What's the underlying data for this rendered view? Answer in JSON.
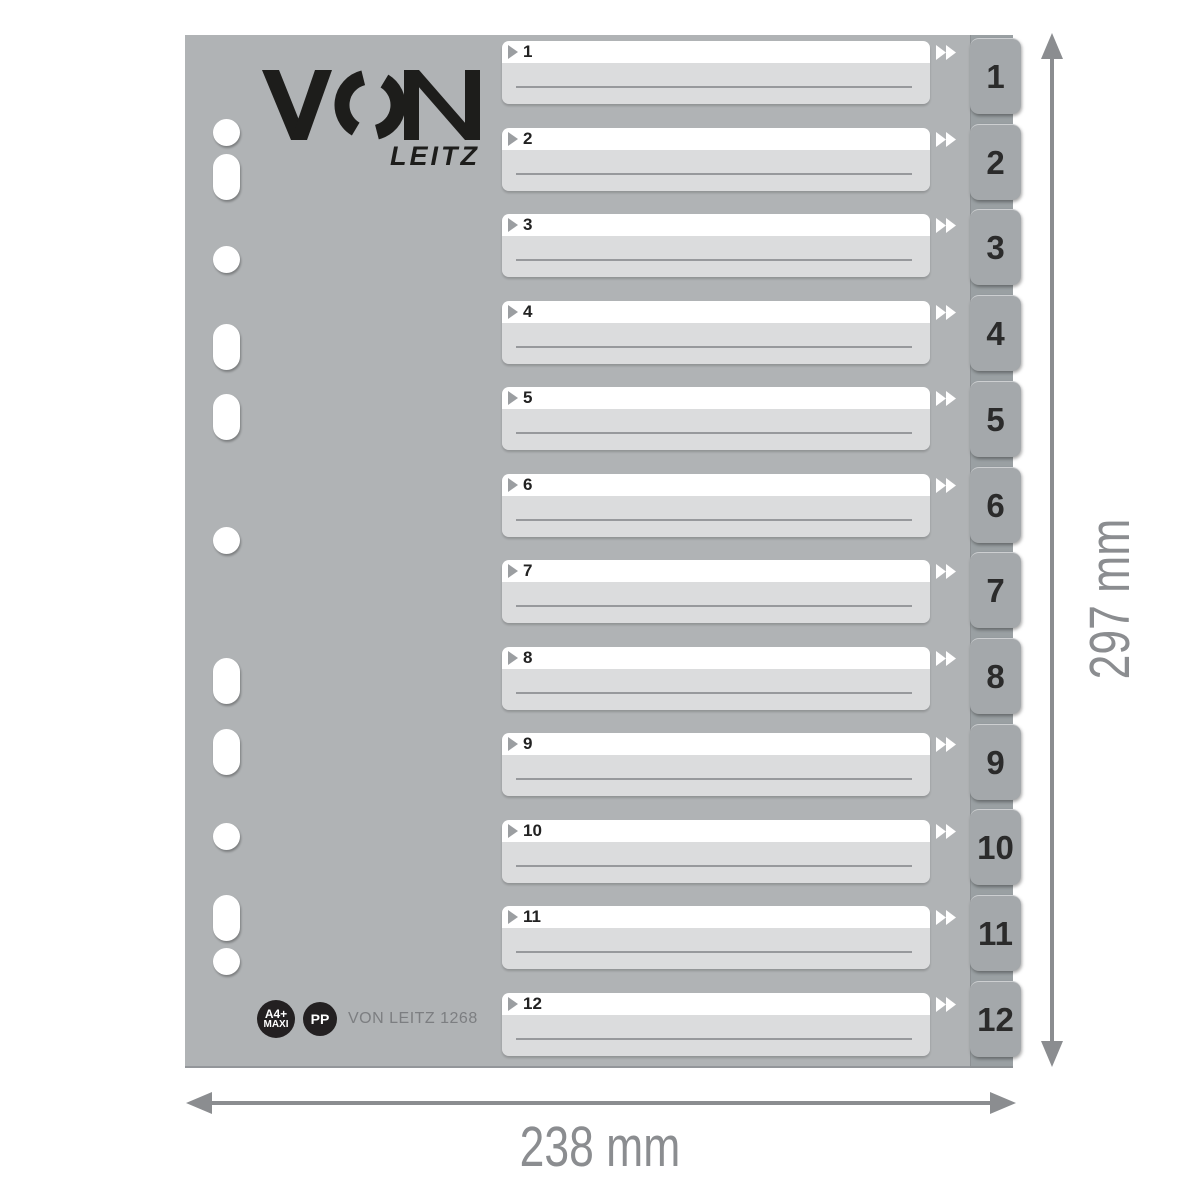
{
  "product": {
    "type_label": "index divider product illustration",
    "logo": {
      "brand": "VON",
      "sub": "LEITZ"
    },
    "badges": {
      "size_line1": "A4+",
      "size_line2": "MAXI",
      "material": "PP",
      "product_code": "VON LEITZ 1268"
    },
    "index_rows": [
      {
        "number": "1"
      },
      {
        "number": "2"
      },
      {
        "number": "3"
      },
      {
        "number": "4"
      },
      {
        "number": "5"
      },
      {
        "number": "6"
      },
      {
        "number": "7"
      },
      {
        "number": "8"
      },
      {
        "number": "9"
      },
      {
        "number": "10"
      },
      {
        "number": "11"
      },
      {
        "number": "12"
      }
    ],
    "tabs": [
      "1",
      "2",
      "3",
      "4",
      "5",
      "6",
      "7",
      "8",
      "9",
      "10",
      "11",
      "12"
    ],
    "holes": [
      {
        "shape": "round",
        "y": 97
      },
      {
        "shape": "oblong",
        "y": 142
      },
      {
        "shape": "round",
        "y": 224
      },
      {
        "shape": "oblong",
        "y": 312
      },
      {
        "shape": "oblong",
        "y": 382
      },
      {
        "shape": "round",
        "y": 505
      },
      {
        "shape": "oblong",
        "y": 646
      },
      {
        "shape": "oblong",
        "y": 717
      },
      {
        "shape": "round",
        "y": 801
      },
      {
        "shape": "oblong",
        "y": 883
      },
      {
        "shape": "round",
        "y": 926
      }
    ],
    "colors": {
      "sheet": "#b0b3b5",
      "tab_band": "#9aa0a3",
      "tab": "#a4a8ab",
      "label_strip": "#ffffff",
      "label_panel": "#dbdcdd",
      "write_line": "#97999c",
      "logo_ink": "#1d1d1b",
      "badge_bg": "#232021",
      "dimension_gray": "#8b8d90",
      "product_code_text": "#7c7e81"
    }
  },
  "dimensions": {
    "width_label": "238 mm",
    "height_label": "297 mm"
  }
}
